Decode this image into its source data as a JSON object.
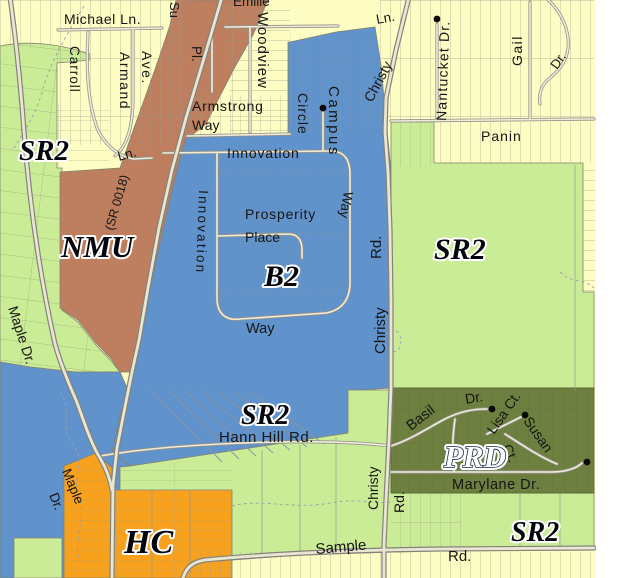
{
  "map": {
    "colors": {
      "residential_yellow": "#fdfdc4",
      "sr2_green": "#cbec97",
      "b2_blue": "#6092cb",
      "nmu_brown": "#bf7f5f",
      "hc_orange": "#f7a11d",
      "prd_olive": "#6e8040",
      "road_gray": "#8f8f85",
      "background_white": "#ffffff"
    },
    "zones": [
      {
        "id": "sr2-west",
        "label": "SR2"
      },
      {
        "id": "nmu",
        "label": "NMU"
      },
      {
        "id": "b2",
        "label": "B2"
      },
      {
        "id": "sr2-east",
        "label": "SR2"
      },
      {
        "id": "sr2-central",
        "label": "SR2"
      },
      {
        "id": "prd",
        "label": "PRD"
      },
      {
        "id": "hc",
        "label": "HC"
      },
      {
        "id": "sr2-southeast",
        "label": "SR2"
      }
    ],
    "streets": [
      {
        "name": "Michael Ln."
      },
      {
        "name": "Su"
      },
      {
        "name": "Emilie"
      },
      {
        "name": "Pl."
      },
      {
        "name": "Woodview"
      },
      {
        "name": "Carroll"
      },
      {
        "name": "Armand"
      },
      {
        "name": "Ave."
      },
      {
        "name": "Ln."
      },
      {
        "name": "Armstrong"
      },
      {
        "name": "Way"
      },
      {
        "name": "Innovation"
      },
      {
        "name": "Campus"
      },
      {
        "name": "Circle"
      },
      {
        "name": "Christy"
      },
      {
        "name": "Ln."
      },
      {
        "name": "Nantucket Dr."
      },
      {
        "name": "Gail"
      },
      {
        "name": "Dr."
      },
      {
        "name": "Panin"
      },
      {
        "name": "(SR 0018)"
      },
      {
        "name": "Innovation"
      },
      {
        "name": "Prosperity"
      },
      {
        "name": "Place"
      },
      {
        "name": "Way"
      },
      {
        "name": "Rd."
      },
      {
        "name": "Christy"
      },
      {
        "name": "Way"
      },
      {
        "name": "Hann Hill Rd."
      },
      {
        "name": "Maple Dr."
      },
      {
        "name": "Basil"
      },
      {
        "name": "Dr."
      },
      {
        "name": "Lisa Ct."
      },
      {
        "name": "Ct."
      },
      {
        "name": "Susan"
      },
      {
        "name": "Marylane Dr."
      },
      {
        "name": "Christy"
      },
      {
        "name": "Rd."
      },
      {
        "name": "Sample"
      },
      {
        "name": "Rd."
      },
      {
        "name": "Maple"
      },
      {
        "name": "Dr."
      }
    ]
  }
}
